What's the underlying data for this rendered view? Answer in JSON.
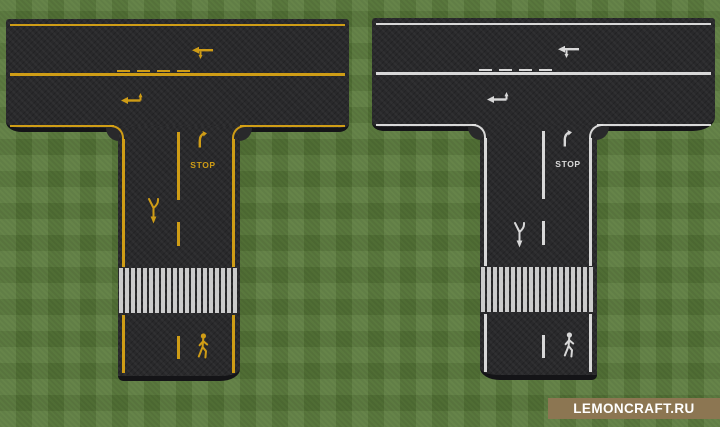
{
  "scene": {
    "description": "Two Minecraft T-intersection asphalt road tiles on grass, one with yellow road markings and one with white road markings",
    "colors": {
      "grass": "#597a3a",
      "asphalt": "#29292b",
      "edge": "#141417",
      "crosswalk": "#d9d9d9"
    }
  },
  "roads": [
    {
      "name": "t-intersection-yellow",
      "marking_color": "#d8a315",
      "marking_color_name": "yellow",
      "stop_label": "STOP",
      "symbols": [
        "edge-lines",
        "solid-center-line",
        "broken-center-line",
        "lane-turn-arrows",
        "merge-arrow",
        "turn-hook-arrow",
        "stop-word-marking",
        "zebra-crosswalk",
        "pedestrian-figure"
      ]
    },
    {
      "name": "t-intersection-white",
      "marking_color": "#e2e2e2",
      "marking_color_name": "white",
      "stop_label": "STOP",
      "symbols": [
        "edge-lines",
        "solid-center-line",
        "broken-center-line",
        "lane-turn-arrows",
        "merge-arrow",
        "turn-hook-arrow",
        "stop-word-marking",
        "zebra-crosswalk",
        "pedestrian-figure"
      ]
    }
  ],
  "watermark": {
    "text": "LEMONCRAFT.RU",
    "background_color": "#8c7652",
    "text_color": "#ffffff"
  }
}
